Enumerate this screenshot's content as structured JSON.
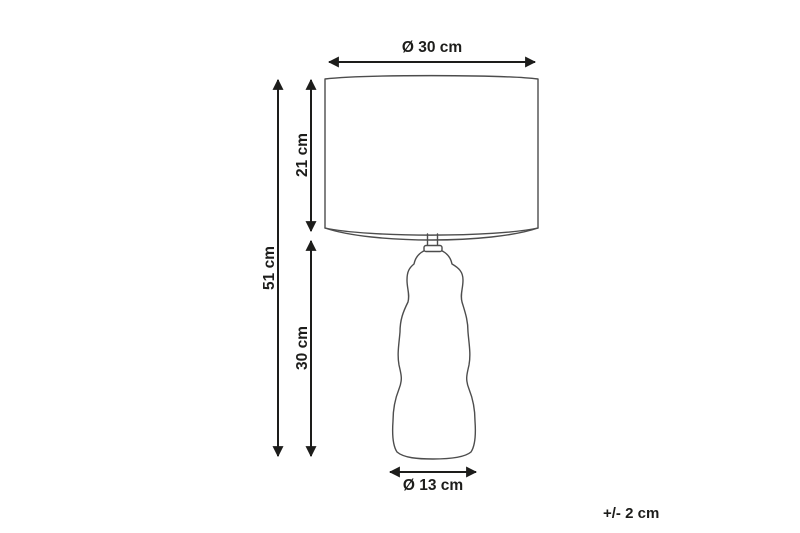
{
  "diagram": {
    "type": "product-dimension-diagram",
    "subject": "table lamp with drum shade and organic sculpted base",
    "colors": {
      "background": "#ffffff",
      "lamp_outline": "#4d4d4d",
      "dimension_lines": "#1d1d1b",
      "text": "#1d1d1b"
    },
    "dimensions": [
      {
        "id": "shade-diameter",
        "label": "Ø 30 cm",
        "value_cm": 30,
        "orientation": "horizontal",
        "refers_to": "lamp shade diameter (top arrow)"
      },
      {
        "id": "total-height",
        "label": "51 cm",
        "value_cm": 51,
        "orientation": "vertical",
        "refers_to": "total lamp height (outer left arrow)"
      },
      {
        "id": "shade-height",
        "label": "21 cm",
        "value_cm": 21,
        "orientation": "vertical",
        "refers_to": "lamp shade height (inner upper arrow)"
      },
      {
        "id": "base-height",
        "label": "30 cm",
        "value_cm": 30,
        "orientation": "vertical",
        "refers_to": "lamp base height (inner lower arrow)"
      },
      {
        "id": "base-diameter",
        "label": "Ø 13 cm",
        "value_cm": 13,
        "orientation": "horizontal",
        "refers_to": "lamp base diameter (bottom arrow)"
      }
    ],
    "tolerance": {
      "label": "+/- 2 cm",
      "value_cm": 2
    }
  }
}
